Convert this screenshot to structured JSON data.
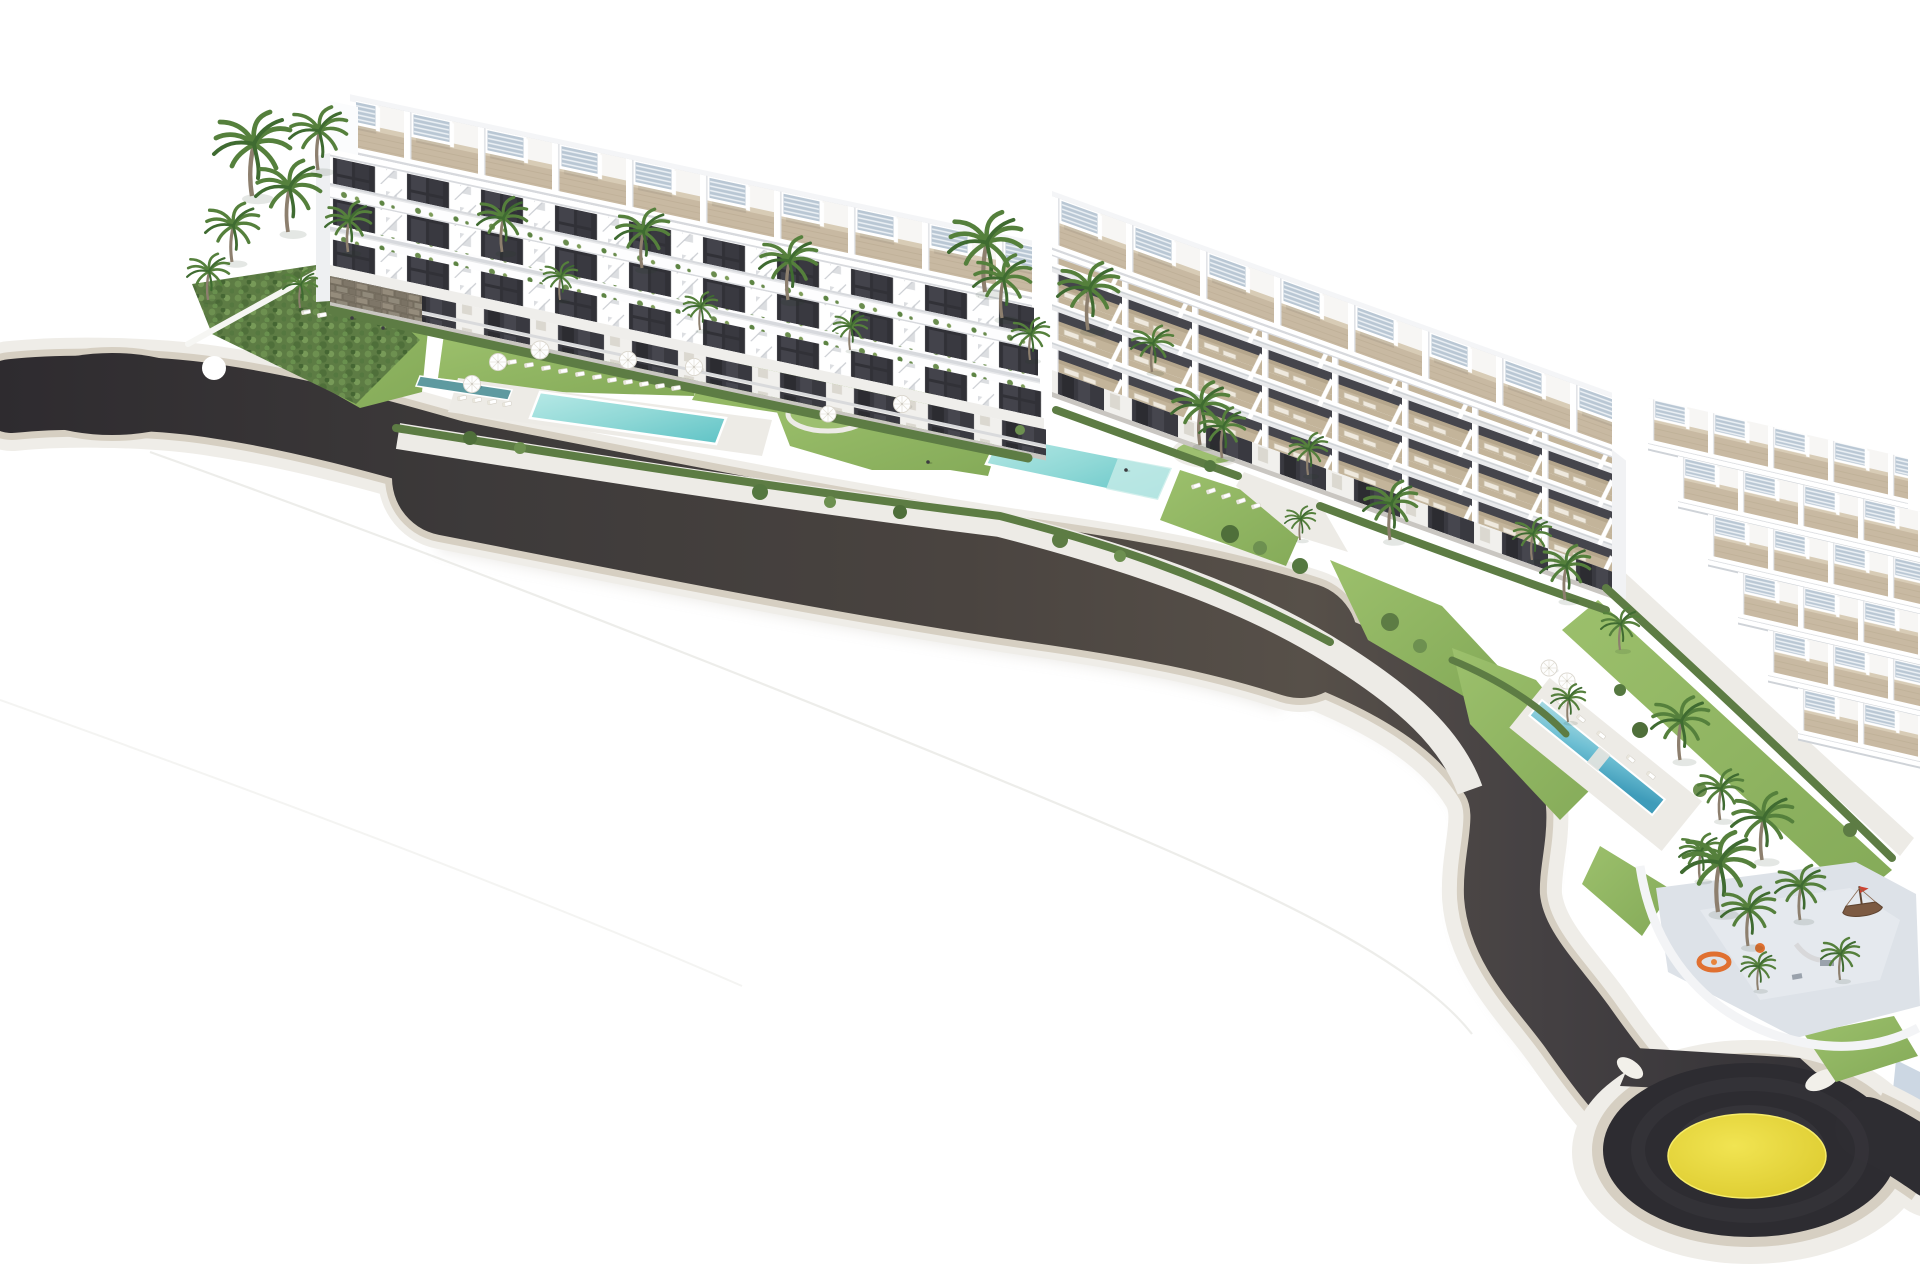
{
  "meta": {
    "description": "Aerial 3D architectural rendering of a white terraced seaside apartment complex with three stepped blocks, roof pergolas, landscaped gardens, three turquoise pools, palm trees, a curving dark asphalt road and a roundabout with a yellow centre island, isolated on a white background."
  },
  "palette": {
    "background": "#ffffff",
    "asphalt_dark": "#2e2b2f",
    "asphalt_mid": "#4a4440",
    "asphalt_light": "#575049",
    "curb": "#d6cfc2",
    "sidewalk": "#efede8",
    "walkway": "#edebe6",
    "roundabout_ring": "#2d2c31",
    "roundabout_center": "#e8d93c",
    "roundabout_center_light": "#f1e452",
    "pool_water_light": "#b7e9e6",
    "pool_water": "#8fd8d6",
    "pool_water_deep": "#5fc3c6",
    "pool3_water": "#6fc0d4",
    "pool3_deep": "#3f9cba",
    "channel_water": "#5e9aa0",
    "lawn_light": "#9cc06c",
    "lawn": "#84aa58",
    "hedge": "#5d7c44",
    "hedge_light": "#6d9050",
    "hedge_dark": "#4f6f3a",
    "palm_frond": "#55803c",
    "palm_frond_dark": "#3f6b31",
    "palm_trunk": "#8d7f6e",
    "building_white": "#ffffff",
    "building_shade": "#e3e4e8",
    "window_dark": "#313137",
    "deck_tan": "#c8b9a2",
    "deck_shadow": "#c3b49a",
    "pergola_slat": "#b9c7d4",
    "stone_wall": "#8a8173",
    "playground_floor": "#dde2e8",
    "play_orange": "#e07030",
    "ship_brown": "#7c5a42",
    "platform_line": "#ebebe8",
    "platform_wall_blue": "#bfcddc"
  },
  "scene": {
    "road": {
      "label": "curved access road with dark asphalt and light stone curbs"
    },
    "roundabout": {
      "label": "roundabout with dark asphalt ring and yellow centre island"
    },
    "blocks": [
      {
        "label": "apartment block 1 with roof pergola terraces",
        "roof_terraces": 9,
        "floors": 4
      },
      {
        "label": "apartment block 2 with stepped sun terraces",
        "roof_terraces": 8,
        "terrace_rows": 3
      },
      {
        "label": "apartment block 3 terraced townhouse rows",
        "rows": 6
      }
    ],
    "pools": [
      {
        "label": "main garden swimming pool"
      },
      {
        "label": "second block swimming pool with stepping stones"
      },
      {
        "label": "third narrow lap pool"
      }
    ],
    "gardens": {
      "label": "landscaped gardens with lawns, hedges, parasols and sun loungers"
    },
    "playground": {
      "label": "children's playground with pirate ship and orange play rings"
    },
    "vegetation": {
      "label": "palm trees"
    }
  }
}
